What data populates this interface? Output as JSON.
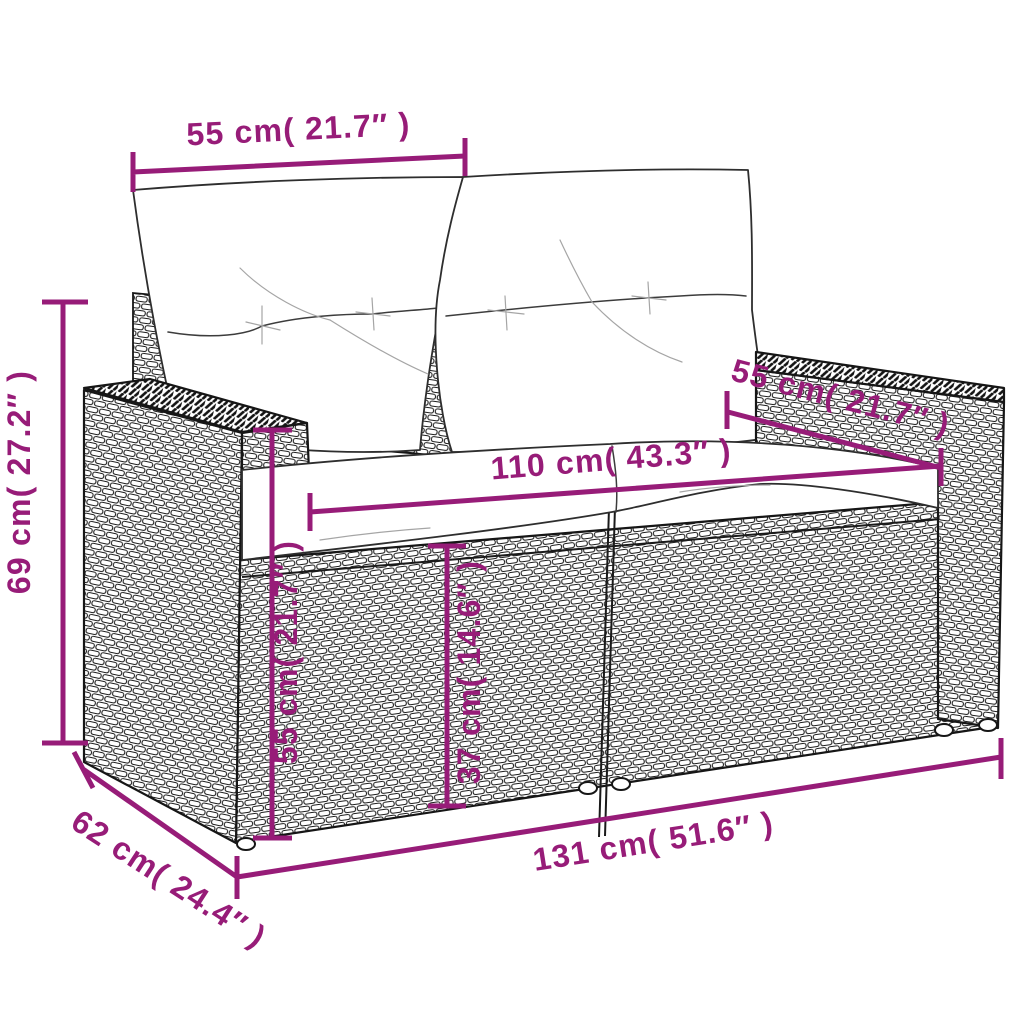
{
  "diagram": {
    "kind": "product-dimension-drawing",
    "subject": "2-seater poly rattan garden sofa with back and seat cushions",
    "accent_color": "#971C78",
    "sketch_line_color": "#161616",
    "cushion_color": "#ffffff",
    "dimensions": {
      "back_cushion_width": "55 cm( 21.7″ )",
      "overall_height": "69 cm( 27.2″ )",
      "armrest_depth": "55 cm( 21.7″ )",
      "seat_width": "110 cm( 43.3″ )",
      "backrest_height": "55 cm( 21.7″ )",
      "seat_height": "37 cm( 14.6″ )",
      "overall_width": "131 cm( 51.6″ )",
      "overall_depth": "62 cm( 24.4″ )"
    }
  }
}
